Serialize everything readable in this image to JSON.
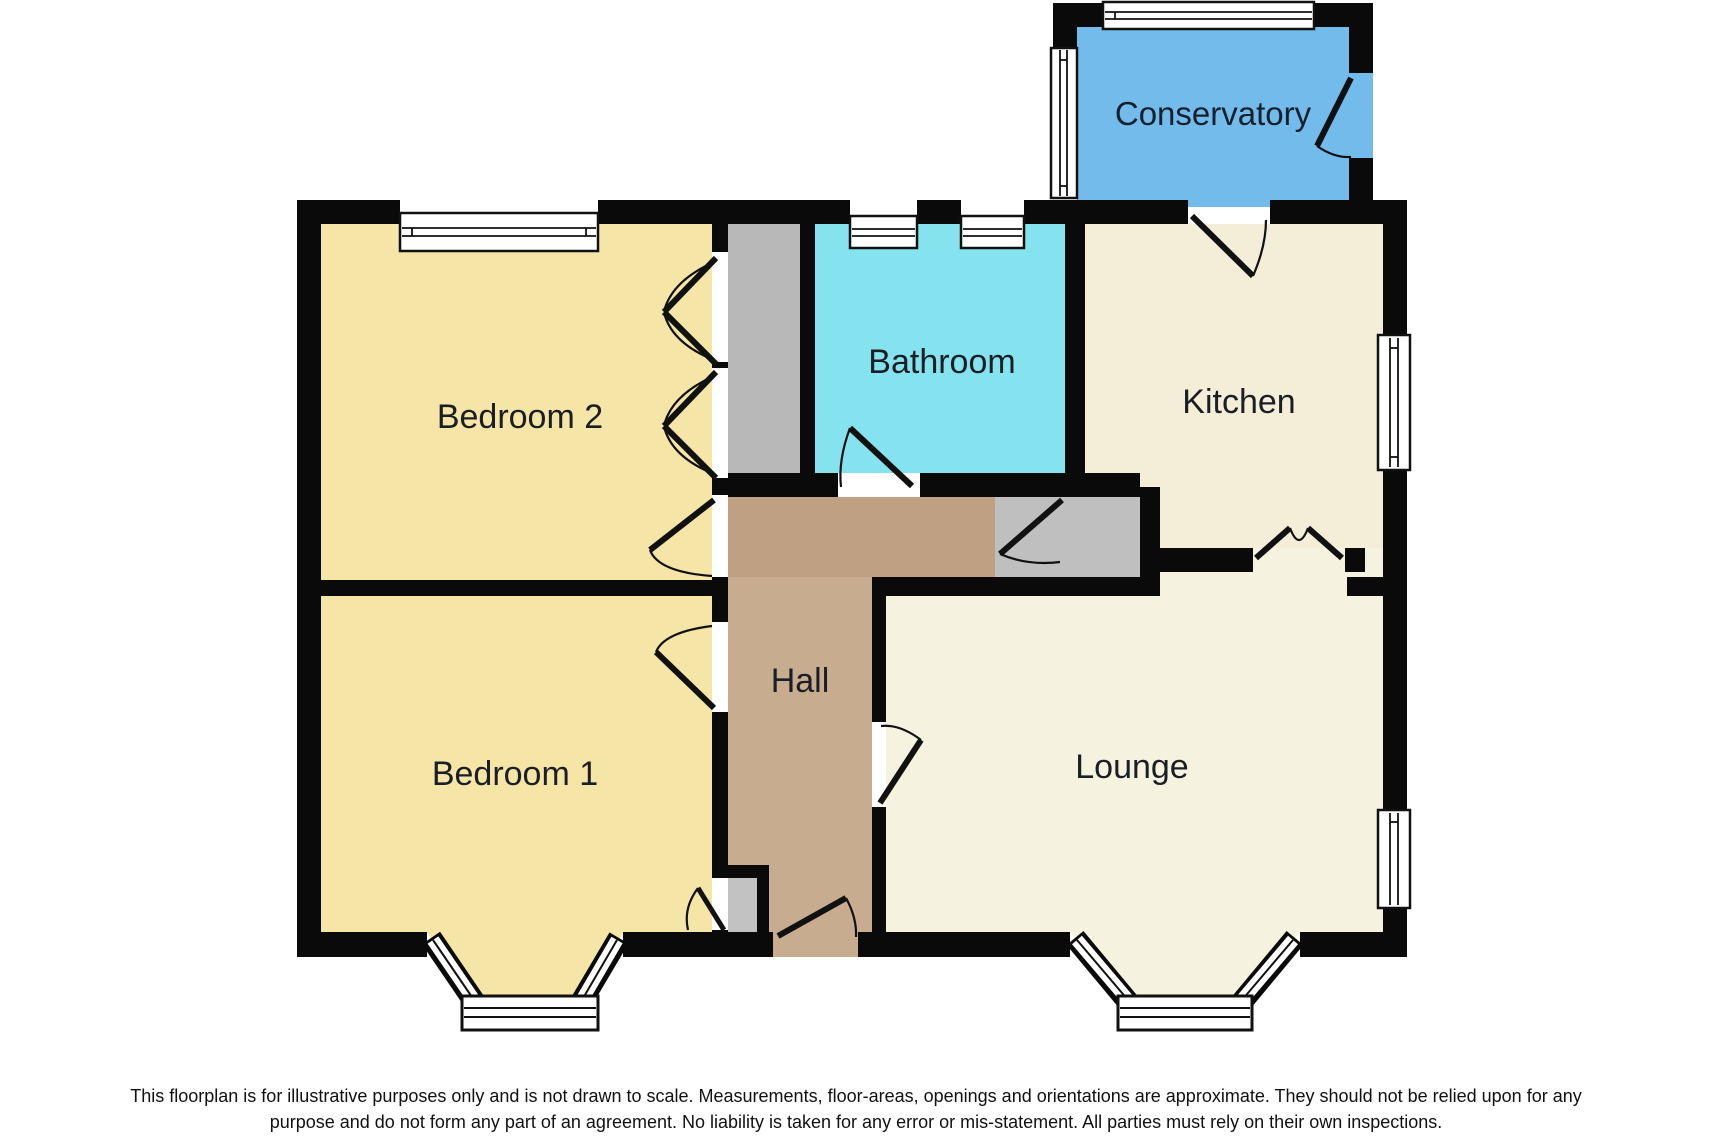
{
  "floorplan": {
    "rooms": {
      "conservatory": {
        "label": "Conservatory",
        "color": "#72BBEA"
      },
      "bathroom": {
        "label": "Bathroom",
        "color": "#84E3EF"
      },
      "kitchen": {
        "label": "Kitchen",
        "color": "#F4EED8"
      },
      "bedroom2": {
        "label": "Bedroom 2",
        "color": "#F5E5A6"
      },
      "bedroom1": {
        "label": "Bedroom 1",
        "color": "#F5E5A6"
      },
      "hall": {
        "label": "Hall",
        "color": "#C8AC8F"
      },
      "lounge": {
        "label": "Lounge",
        "color": "#F6F2E0"
      }
    },
    "hall_upper_color": "#BFA083",
    "storage_color": "#BDBDBD",
    "wall_color": "#0a0a0a",
    "disclaimer": {
      "line1": "This floorplan is for illustrative purposes only and is not drawn to scale. Measurements, floor-areas, openings and orientations are approximate. They should not be relied upon for any",
      "line2": "purpose and do not form any part of an agreement. No liability is taken for any error or mis-statement. All parties must rely on their own inspections."
    }
  }
}
